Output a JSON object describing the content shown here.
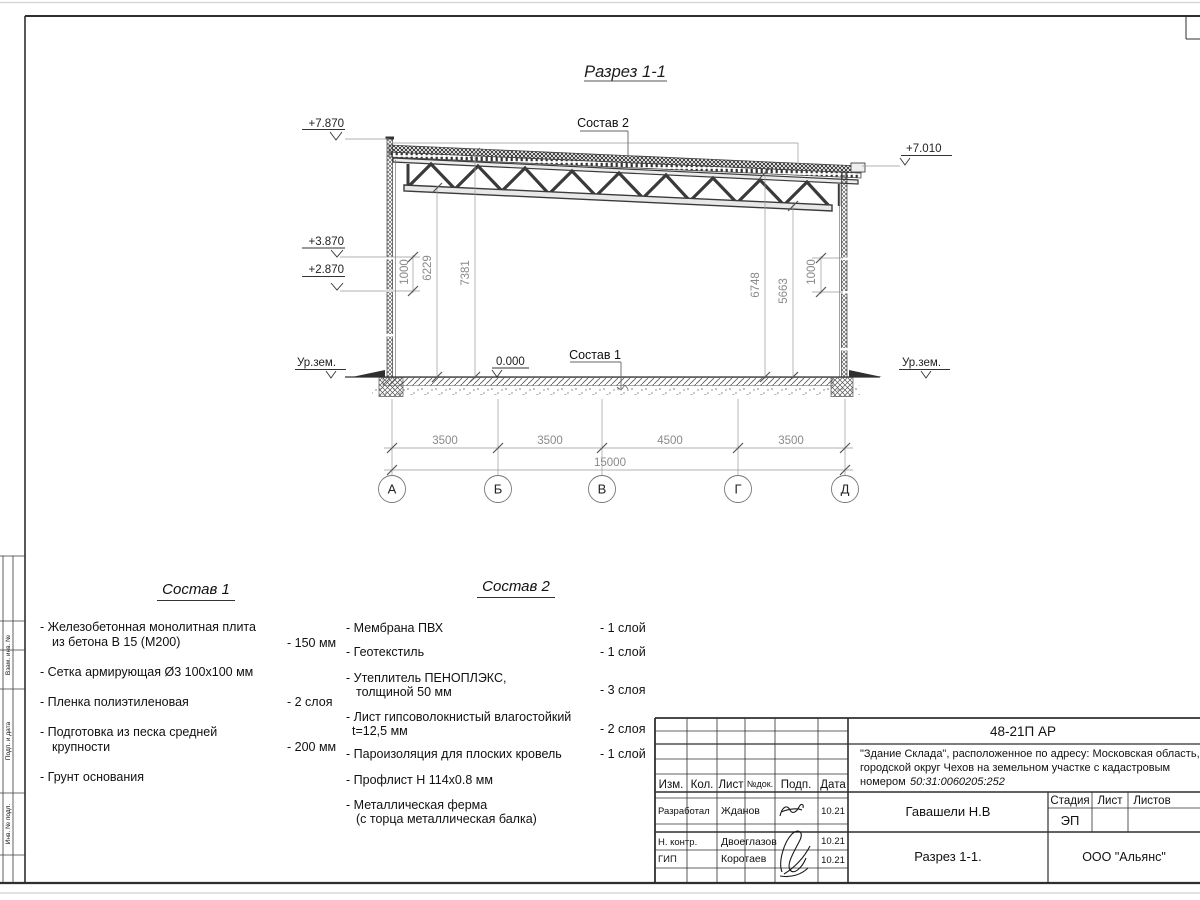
{
  "sheet": {
    "title": "Разрез 1-1"
  },
  "drawing": {
    "labels": {
      "sostav1_ref": "Состав 1",
      "sostav2_ref": "Состав 2"
    },
    "elevations": {
      "parapet": "+7.870",
      "roof_right": "+7.010",
      "mid_upper": "+3.870",
      "mid_lower": "+2.870",
      "floor": "0.000",
      "ground_left": "Ур.зем.",
      "ground_right": "Ур.зем."
    },
    "vertical_dims": {
      "left_panel": "1000",
      "left_truss": "6229",
      "left_roof": "7381",
      "right_roof": "6748",
      "right_truss": "5663",
      "right_panel": "1000"
    },
    "horizontal_dims": {
      "spans": [
        "3500",
        "3500",
        "4500",
        "3500"
      ],
      "total": "15000"
    },
    "axes": [
      "А",
      "Б",
      "В",
      "Г",
      "Д"
    ]
  },
  "sostav1": {
    "title": "Состав 1",
    "items": [
      {
        "line1": "- Железобетонная  монолитная плита",
        "line2": "из бетона В 15 (М200)",
        "value": "- 150 мм"
      },
      {
        "line1": "- Сетка армирующая Ø3 100х100 мм"
      },
      {
        "line1": "- Пленка полиэтиленовая",
        "value": "-  2 слоя"
      },
      {
        "line1": "- Подготовка из песка средней",
        "line2": "крупности",
        "value": "- 200 мм"
      },
      {
        "line1": "- Грунт основания"
      }
    ]
  },
  "sostav2": {
    "title": "Состав 2",
    "items": [
      {
        "line1": "- Мембрана ПВХ",
        "value": "- 1 слой"
      },
      {
        "line1": "- Геотекстиль",
        "value": "- 1 слой"
      },
      {
        "line1": "- Утеплитель ПЕНОПЛЭКС,",
        "line2": "толщиной 50 мм",
        "value": "- 3 слоя"
      },
      {
        "line1": "- Лист гипсоволокнистый влагостойкий",
        "line2": "t=12,5 мм",
        "value": "- 2 слоя"
      },
      {
        "line1": "- Пароизоляция для плоских кровель",
        "value": "- 1 слой"
      },
      {
        "line1": "- Профлист Н 114х0.8 мм"
      },
      {
        "line1": "- Металлическая ферма",
        "line2": "(с торца металлическая балка)"
      }
    ]
  },
  "titleblock": {
    "doc_number": "48-21П АР",
    "project_line1": "\"Здание Склада\", расположенное по адресу: Московская область,",
    "project_line2": "городской округ Чехов на земельном участке с кадастровым",
    "project_line3_prefix": "номером ",
    "project_cadastral": "50:31:0060205:252",
    "header_cols": [
      "Изм.",
      "Кол.",
      "Лист",
      "№док.",
      "Подп.",
      "Дата"
    ],
    "rows": [
      {
        "role": "Разработал",
        "name": "Жданов",
        "date": "10.21"
      },
      {
        "role": "Н. контр.",
        "name": "Двоеглазов",
        "date": "10.21"
      },
      {
        "role": "ГИП",
        "name": "Коротаев",
        "date": "10.21"
      }
    ],
    "chief": "Гавашели Н.В",
    "stage_label": "Стадия",
    "sheet_label": "Лист",
    "sheets_label": "Листов",
    "stage_value": "ЭП",
    "drawing_name": "Разрез 1-1.",
    "company": "ООО \"Альянс\""
  },
  "frame_strip": {
    "cells": [
      "Взам. инв. №",
      "Подп. и дата",
      "Инв. № подл."
    ]
  }
}
